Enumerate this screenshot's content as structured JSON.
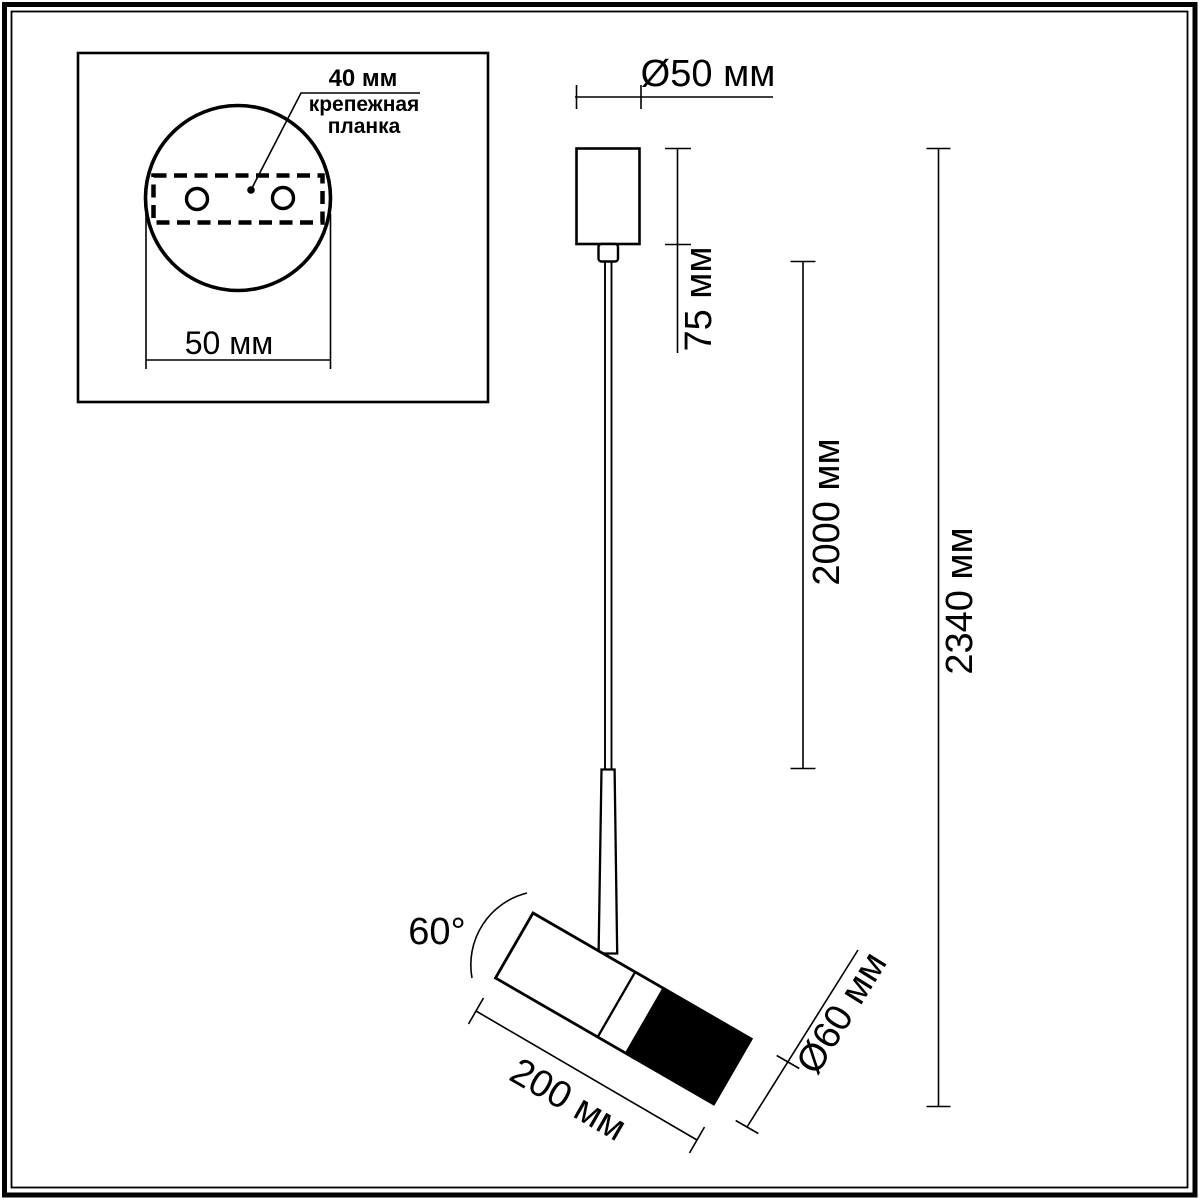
{
  "page": {
    "background": "#ffffff",
    "line_color": "#000000"
  },
  "inset": {
    "hole_spacing_label": "40 мм",
    "plate_label_line1": "крепежная",
    "plate_label_line2": "планка",
    "base_width_label": "50 мм"
  },
  "dimensions": {
    "canopy_diameter": "Ø50 мм",
    "canopy_height": "75 мм",
    "cable_length": "2000 мм",
    "overall_height": "2340 мм",
    "head_tilt_angle": "60°",
    "head_length": "200 мм",
    "head_diameter": "Ø60 мм"
  }
}
